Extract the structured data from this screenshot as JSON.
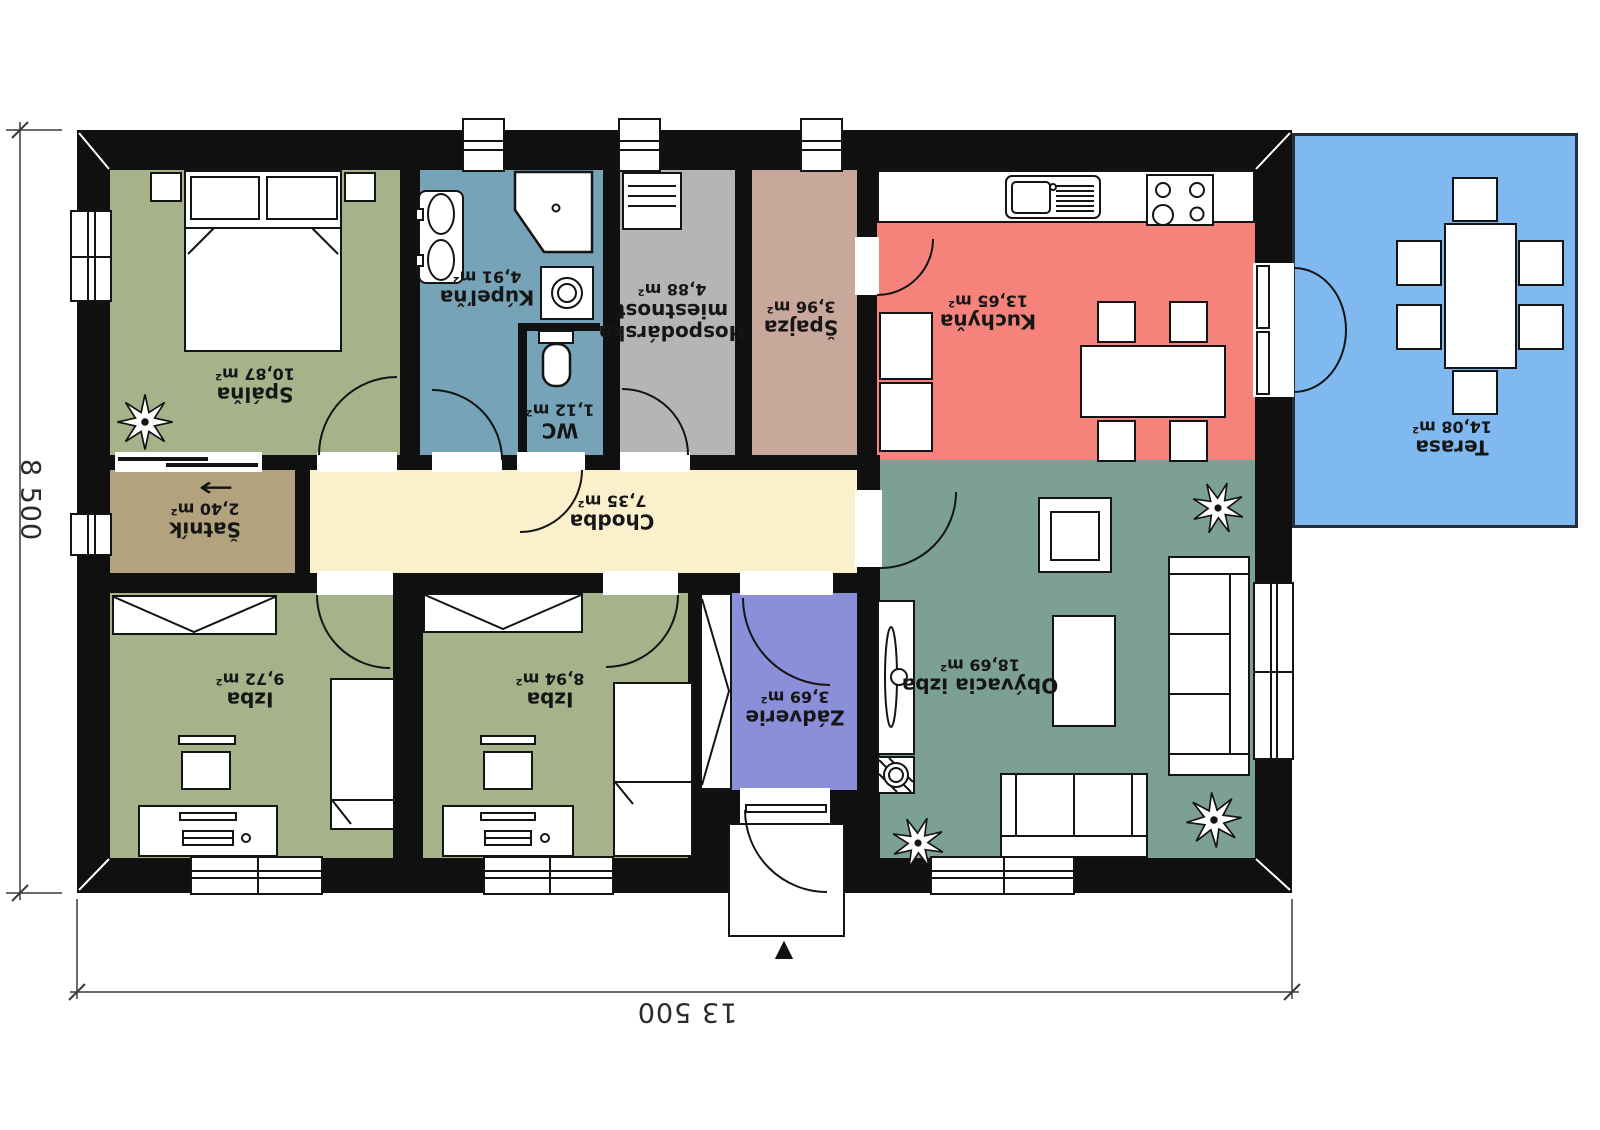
{
  "dimensions": {
    "width_label": "13 500",
    "height_label": "8 500"
  },
  "rooms": {
    "spalna": {
      "name": "Spálňa",
      "area": "10,87 m²"
    },
    "kupelna": {
      "name": "Kúpeľňa",
      "area": "4,91 m²"
    },
    "wc": {
      "name": "WC",
      "area": "1,12 m²"
    },
    "hospodarska": {
      "name": "Hospodárska miestnosť",
      "area": "4,88 m²"
    },
    "spajza": {
      "name": "Špajza",
      "area": "3,96 m²"
    },
    "kuchyna": {
      "name": "Kuchyňa",
      "area": "13,65 m²"
    },
    "terasa": {
      "name": "Terasa",
      "area": "14,08 m²"
    },
    "satnik": {
      "name": "Šatník",
      "area": "2,40 m²"
    },
    "chodba": {
      "name": "Chodba",
      "area": "7,35 m²"
    },
    "izba1": {
      "name": "Izba",
      "area": "9,72 m²"
    },
    "izba2": {
      "name": "Izba",
      "area": "8,94 m²"
    },
    "zadverie": {
      "name": "Zádverie",
      "area": "3,69 m²"
    },
    "obyvacia": {
      "name": "Obývacia izba",
      "area": "18,69 m²"
    }
  },
  "symbols": {
    "satnik_arrow": "←",
    "entrance_marker": "▲"
  },
  "palette": {
    "wall": "#101010",
    "bedroom_green": "#a5b28a",
    "bathroom_blue": "#76a3b8",
    "utility_gray": "#b5b5b5",
    "pantry_rose": "#c9a89c",
    "kitchen_red": "#f5837b",
    "terrace_blue": "#80b9f0",
    "closet_tan": "#b2a37e",
    "hall_cream": "#faf0cc",
    "entry_purple": "#8b8ed9",
    "living_teal": "#7da095",
    "dimension_text": "#2b2b2b"
  }
}
